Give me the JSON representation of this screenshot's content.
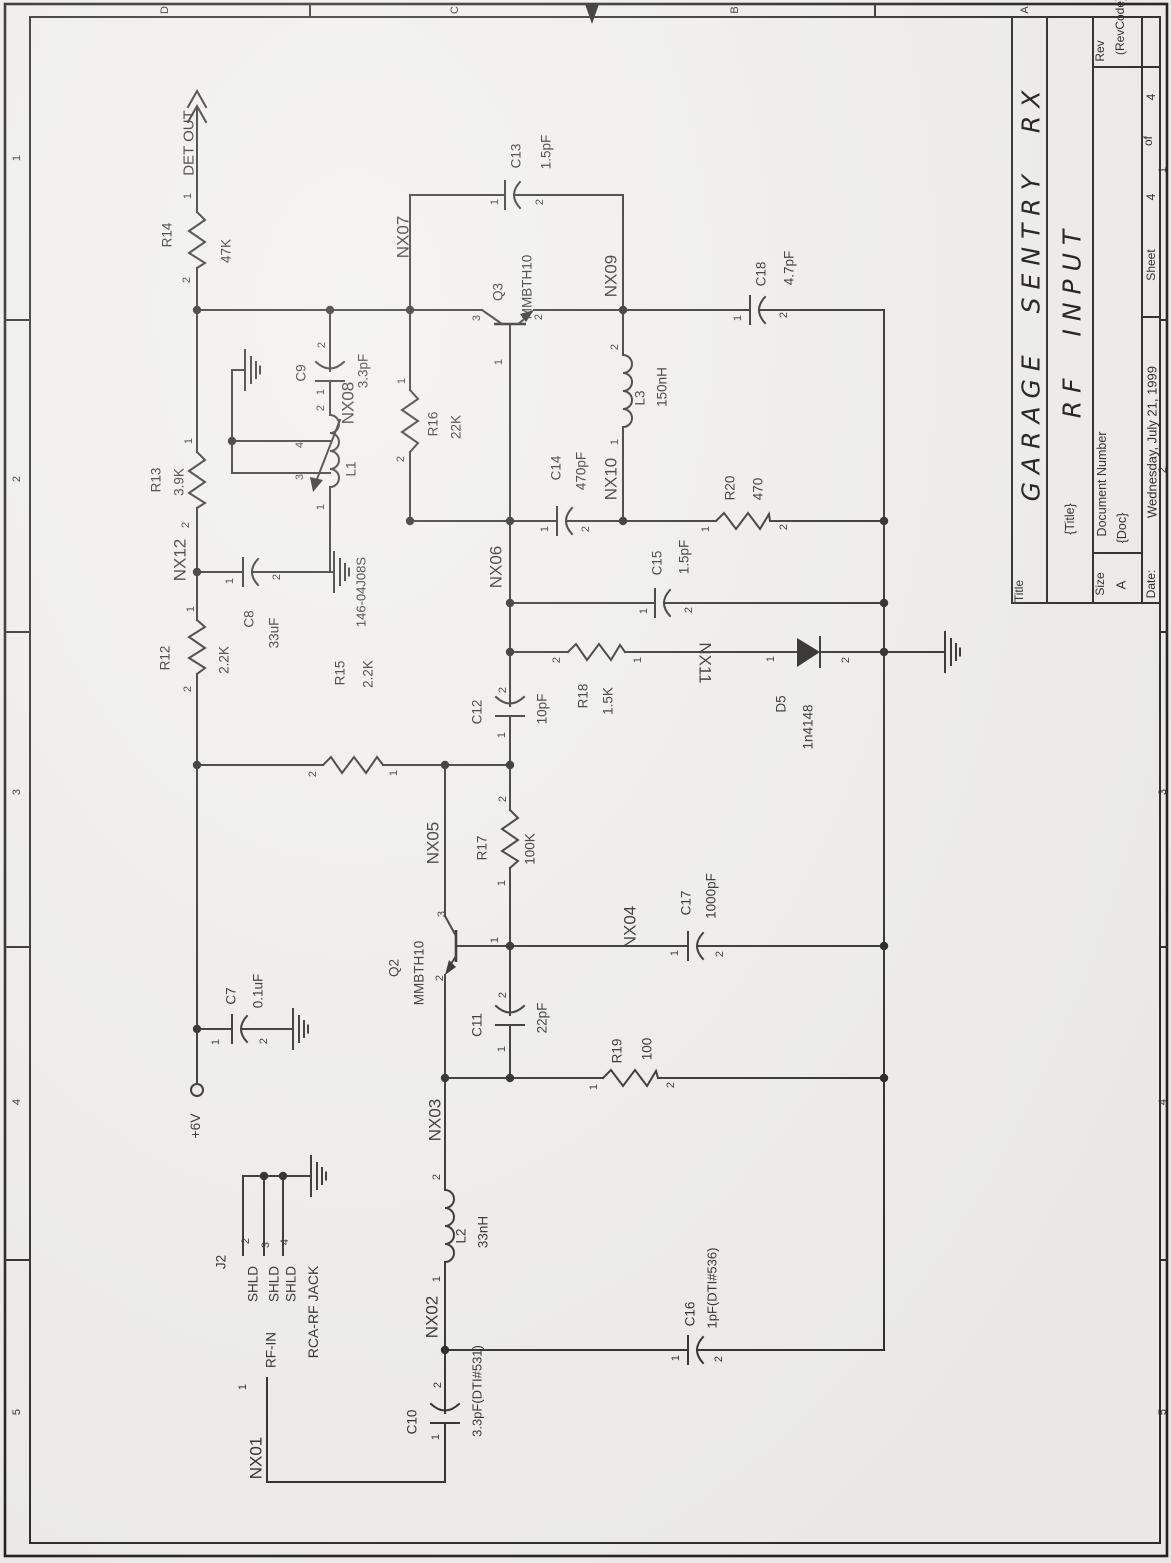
{
  "colors": {
    "paper": "#f1f0ed",
    "ink": "#2b2a28"
  },
  "document_type": "scanned schematic sheet",
  "title_block": {
    "title": "GARAGE SENTRY RX",
    "subtitle": "RF INPUT",
    "size": "A",
    "doc": "{Doc}",
    "rev": "(RevCode)",
    "date": "Wednesday, July 21, 1999",
    "sheet": "4",
    "sheet_of": "4"
  },
  "labels": [
    {
      "n": "zone-letter-d",
      "t": "D",
      "x": 165,
      "y": 10,
      "s": 11
    },
    {
      "n": "zone-letter-c",
      "t": "C",
      "x": 455,
      "y": 10,
      "s": 11
    },
    {
      "n": "zone-letter-b",
      "t": "B",
      "x": 735,
      "y": 10,
      "s": 11
    },
    {
      "n": "zone-letter-a",
      "t": "A",
      "x": 1025,
      "y": 10,
      "s": 11
    },
    {
      "n": "zone-num-left-1",
      "t": "1",
      "x": 17,
      "y": 158,
      "s": 11
    },
    {
      "n": "zone-num-left-2",
      "t": "2",
      "x": 17,
      "y": 479,
      "s": 11
    },
    {
      "n": "zone-num-left-3",
      "t": "3",
      "x": 17,
      "y": 792,
      "s": 11
    },
    {
      "n": "zone-num-left-4",
      "t": "4",
      "x": 17,
      "y": 1102,
      "s": 11
    },
    {
      "n": "zone-num-left-5",
      "t": "5",
      "x": 17,
      "y": 1412,
      "s": 11
    },
    {
      "n": "zone-num-right-1",
      "t": "1",
      "x": 1163,
      "y": 170,
      "s": 11
    },
    {
      "n": "zone-num-right-2",
      "t": "2",
      "x": 1163,
      "y": 470,
      "s": 11
    },
    {
      "n": "zone-num-right-3",
      "t": "3",
      "x": 1163,
      "y": 792,
      "s": 11
    },
    {
      "n": "zone-num-right-4",
      "t": "4",
      "x": 1163,
      "y": 1102,
      "s": 11
    },
    {
      "n": "zone-num-right-5",
      "t": "5",
      "x": 1163,
      "y": 1412,
      "s": 11
    },
    {
      "n": "tb-title-label",
      "t": "Title",
      "x": 1019,
      "y": 591,
      "s": 12
    },
    {
      "n": "tb-title-value",
      "t": "GARAGE SENTRY RX",
      "x": 1031,
      "y": 292,
      "s": 25,
      "c": "hand"
    },
    {
      "n": "tb-subtitle-label",
      "t": "{Title}",
      "x": 1070,
      "y": 519,
      "s": 12.5
    },
    {
      "n": "tb-subtitle-value",
      "t": "RF INPUT",
      "x": 1072,
      "y": 320,
      "s": 25,
      "c": "hand"
    },
    {
      "n": "tb-rev-label",
      "t": "Rev",
      "x": 1100,
      "y": 51,
      "s": 12
    },
    {
      "n": "tb-rev-value",
      "t": "(RevCode)",
      "x": 1120,
      "y": 26,
      "s": 12
    },
    {
      "n": "tb-doc-label",
      "t": "Document Number",
      "x": 1102,
      "y": 484,
      "s": 12.5
    },
    {
      "n": "tb-doc-value",
      "t": "{Doc}",
      "x": 1122,
      "y": 528,
      "s": 12.5
    },
    {
      "n": "tb-size-label",
      "t": "Size",
      "x": 1100,
      "y": 584,
      "s": 12
    },
    {
      "n": "tb-size-value",
      "t": "A",
      "x": 1121,
      "y": 585,
      "s": 13
    },
    {
      "n": "tb-date-label",
      "t": "Date:",
      "x": 1151,
      "y": 584,
      "s": 12
    },
    {
      "n": "tb-date-value",
      "t": "Wednesday, July 21, 1999",
      "x": 1152,
      "y": 442,
      "s": 13
    },
    {
      "n": "tb-sheet-label",
      "t": "Sheet",
      "x": 1151,
      "y": 265,
      "s": 12
    },
    {
      "n": "tb-sheet-num",
      "t": "4",
      "x": 1151,
      "y": 197,
      "s": 12
    },
    {
      "n": "tb-of-label",
      "t": "of",
      "x": 1148,
      "y": 141,
      "s": 12
    },
    {
      "n": "tb-sheet-total",
      "t": "4",
      "x": 1151,
      "y": 97,
      "s": 12
    },
    {
      "n": "net-det-out",
      "t": "DET OUT",
      "x": 189,
      "y": 143,
      "s": 15
    },
    {
      "n": "r14-pin1",
      "t": "1",
      "x": 188,
      "y": 196,
      "s": 11
    },
    {
      "n": "r14-ref",
      "t": "R14",
      "x": 167,
      "y": 235
    },
    {
      "n": "r14-val",
      "t": "47K",
      "x": 226,
      "y": 251
    },
    {
      "n": "r14-pin2",
      "t": "2",
      "x": 187,
      "y": 280,
      "s": 11
    },
    {
      "n": "r13-pin1",
      "t": "1",
      "x": 189,
      "y": 441,
      "s": 11
    },
    {
      "n": "r13-ref",
      "t": "R13",
      "x": 156,
      "y": 480
    },
    {
      "n": "r13-val",
      "t": "3.9K",
      "x": 179,
      "y": 482
    },
    {
      "n": "r13-pin2",
      "t": "2",
      "x": 186,
      "y": 525,
      "s": 11
    },
    {
      "n": "net-nx12",
      "t": "NX12",
      "x": 180,
      "y": 560,
      "s": 17
    },
    {
      "n": "r12-pin1",
      "t": "1",
      "x": 191,
      "y": 609,
      "s": 11
    },
    {
      "n": "r12-ref",
      "t": "R12",
      "x": 165,
      "y": 658
    },
    {
      "n": "r12-val",
      "t": "2.2K",
      "x": 224,
      "y": 660
    },
    {
      "n": "r12-pin2",
      "t": "2",
      "x": 188,
      "y": 689,
      "s": 11
    },
    {
      "n": "c8-pin1",
      "t": "1",
      "x": 230,
      "y": 581,
      "s": 11
    },
    {
      "n": "c8-ref",
      "t": "C8",
      "x": 249,
      "y": 619
    },
    {
      "n": "c8-val",
      "t": "33uF",
      "x": 274,
      "y": 633
    },
    {
      "n": "c8-pin2",
      "t": "2",
      "x": 277,
      "y": 577,
      "s": 11
    },
    {
      "n": "l1-part",
      "t": "146-04J08S",
      "x": 361,
      "y": 592,
      "s": 13
    },
    {
      "n": "c9-pin2",
      "t": "2",
      "x": 322,
      "y": 345,
      "s": 11
    },
    {
      "n": "c9-ref",
      "t": "C9",
      "x": 301,
      "y": 373
    },
    {
      "n": "c9-val",
      "t": "3.3pF",
      "x": 363,
      "y": 371
    },
    {
      "n": "c9-pin1",
      "t": "1",
      "x": 321,
      "y": 392,
      "s": 11
    },
    {
      "n": "net-nx08",
      "t": "NX08",
      "x": 348,
      "y": 403,
      "s": 17
    },
    {
      "n": "l1-pin2",
      "t": "2",
      "x": 321,
      "y": 408,
      "s": 11
    },
    {
      "n": "l1-ref",
      "t": "L1",
      "x": 351,
      "y": 469
    },
    {
      "n": "l1-pin4",
      "t": "4",
      "x": 300,
      "y": 445,
      "s": 11
    },
    {
      "n": "l1-pin3",
      "t": "3",
      "x": 300,
      "y": 477,
      "s": 11
    },
    {
      "n": "l1-pin1",
      "t": "1",
      "x": 321,
      "y": 507,
      "s": 11
    },
    {
      "n": "net-nx07",
      "t": "NX07",
      "x": 403,
      "y": 237,
      "s": 17
    },
    {
      "n": "c13-pin1",
      "t": "1",
      "x": 495,
      "y": 202,
      "s": 11
    },
    {
      "n": "c13-ref",
      "t": "C13",
      "x": 516,
      "y": 156
    },
    {
      "n": "c13-val",
      "t": "1.5pF",
      "x": 546,
      "y": 152
    },
    {
      "n": "c13-pin2",
      "t": "2",
      "x": 540,
      "y": 202,
      "s": 11
    },
    {
      "n": "r16-pin1",
      "t": "1",
      "x": 402,
      "y": 381,
      "s": 11
    },
    {
      "n": "r16-ref",
      "t": "R16",
      "x": 433,
      "y": 424
    },
    {
      "n": "r16-val",
      "t": "22K",
      "x": 456,
      "y": 427
    },
    {
      "n": "r16-pin2",
      "t": "2",
      "x": 401,
      "y": 459,
      "s": 11
    },
    {
      "n": "q3-ref",
      "t": "Q3",
      "x": 498,
      "y": 292
    },
    {
      "n": "q3-val",
      "t": "MMBTH10",
      "x": 527,
      "y": 287
    },
    {
      "n": "q3-pin3",
      "t": "3",
      "x": 477,
      "y": 318,
      "s": 11
    },
    {
      "n": "q3-pin2",
      "t": "2",
      "x": 539,
      "y": 317,
      "s": 11
    },
    {
      "n": "q3-pin1",
      "t": "1",
      "x": 499,
      "y": 362,
      "s": 11
    },
    {
      "n": "net-nx09",
      "t": "NX09",
      "x": 611,
      "y": 276,
      "s": 17
    },
    {
      "n": "c18-pin1",
      "t": "1",
      "x": 738,
      "y": 318,
      "s": 11
    },
    {
      "n": "c18-ref",
      "t": "C18",
      "x": 761,
      "y": 274
    },
    {
      "n": "c18-val",
      "t": "4.7pF",
      "x": 789,
      "y": 268
    },
    {
      "n": "c18-pin2",
      "t": "2",
      "x": 784,
      "y": 315,
      "s": 11
    },
    {
      "n": "l3-pin2",
      "t": "2",
      "x": 615,
      "y": 347,
      "s": 11
    },
    {
      "n": "l3-ref",
      "t": "L3",
      "x": 640,
      "y": 398
    },
    {
      "n": "l3-val",
      "t": "150nH",
      "x": 662,
      "y": 387
    },
    {
      "n": "l3-pin1",
      "t": "1",
      "x": 615,
      "y": 442,
      "s": 11
    },
    {
      "n": "net-nx10",
      "t": "NX10",
      "x": 611,
      "y": 479,
      "s": 17
    },
    {
      "n": "c14-pin1",
      "t": "1",
      "x": 545,
      "y": 529,
      "s": 11
    },
    {
      "n": "c14-ref",
      "t": "C14",
      "x": 556,
      "y": 468
    },
    {
      "n": "c14-val",
      "t": "470pF",
      "x": 581,
      "y": 471
    },
    {
      "n": "c14-pin2",
      "t": "2",
      "x": 586,
      "y": 529,
      "s": 11
    },
    {
      "n": "r20-pin1",
      "t": "1",
      "x": 706,
      "y": 529,
      "s": 11
    },
    {
      "n": "r20-ref",
      "t": "R20",
      "x": 730,
      "y": 488
    },
    {
      "n": "r20-val",
      "t": "470",
      "x": 758,
      "y": 489
    },
    {
      "n": "r20-pin2",
      "t": "2",
      "x": 784,
      "y": 527,
      "s": 11
    },
    {
      "n": "net-nx06",
      "t": "NX06",
      "x": 496,
      "y": 567,
      "s": 17
    },
    {
      "n": "c15-pin1",
      "t": "1",
      "x": 644,
      "y": 611,
      "s": 11
    },
    {
      "n": "c15-ref",
      "t": "C15",
      "x": 657,
      "y": 563
    },
    {
      "n": "c15-val",
      "t": "1.5pF",
      "x": 684,
      "y": 557
    },
    {
      "n": "c15-pin2",
      "t": "2",
      "x": 689,
      "y": 610,
      "s": 11
    },
    {
      "n": "r18-pin2",
      "t": "2",
      "x": 557,
      "y": 660,
      "s": 11
    },
    {
      "n": "r18-ref",
      "t": "R18",
      "x": 583,
      "y": 696
    },
    {
      "n": "r18-val",
      "t": "1.5K",
      "x": 608,
      "y": 701
    },
    {
      "n": "r18-pin1",
      "t": "1",
      "x": 638,
      "y": 660,
      "s": 11
    },
    {
      "n": "net-nx11",
      "t": "NX11",
      "x": 705,
      "y": 663,
      "s": 17,
      "r": 90
    },
    {
      "n": "d5-pin1",
      "t": "1",
      "x": 771,
      "y": 659,
      "s": 11
    },
    {
      "n": "d5-ref",
      "t": "D5",
      "x": 781,
      "y": 704
    },
    {
      "n": "d5-val",
      "t": "1n4148",
      "x": 808,
      "y": 727
    },
    {
      "n": "d5-pin2",
      "t": "2",
      "x": 846,
      "y": 660,
      "s": 11
    },
    {
      "n": "r15-pin2",
      "t": "2",
      "x": 313,
      "y": 774,
      "s": 11
    },
    {
      "n": "r15-ref",
      "t": "R15",
      "x": 340,
      "y": 673
    },
    {
      "n": "r15-val",
      "t": "2.2K",
      "x": 368,
      "y": 674
    },
    {
      "n": "r15-pin1",
      "t": "1",
      "x": 394,
      "y": 773,
      "s": 11
    },
    {
      "n": "c12-pin2",
      "t": "2",
      "x": 503,
      "y": 690,
      "s": 11
    },
    {
      "n": "c12-ref",
      "t": "C12",
      "x": 477,
      "y": 712
    },
    {
      "n": "c12-val",
      "t": "10pF",
      "x": 542,
      "y": 709
    },
    {
      "n": "c12-pin1",
      "t": "1",
      "x": 502,
      "y": 735,
      "s": 11
    },
    {
      "n": "net-nx05",
      "t": "NX05",
      "x": 433,
      "y": 843,
      "s": 17
    },
    {
      "n": "r17-pin2",
      "t": "2",
      "x": 503,
      "y": 799,
      "s": 11
    },
    {
      "n": "r17-ref",
      "t": "R17",
      "x": 482,
      "y": 848
    },
    {
      "n": "r17-val",
      "t": "100K",
      "x": 530,
      "y": 849
    },
    {
      "n": "r17-pin1",
      "t": "1",
      "x": 502,
      "y": 883,
      "s": 11
    },
    {
      "n": "q2-ref",
      "t": "Q2",
      "x": 394,
      "y": 968
    },
    {
      "n": "q2-val",
      "t": "MMBTH10",
      "x": 419,
      "y": 973
    },
    {
      "n": "q2-pin3",
      "t": "3",
      "x": 442,
      "y": 914,
      "s": 11
    },
    {
      "n": "q2-pin1",
      "t": "1",
      "x": 495,
      "y": 940,
      "s": 11
    },
    {
      "n": "q2-pin2",
      "t": "2",
      "x": 440,
      "y": 978,
      "s": 11
    },
    {
      "n": "net-nx04",
      "t": "NX04",
      "x": 630,
      "y": 927,
      "s": 17
    },
    {
      "n": "c17-pin1",
      "t": "1",
      "x": 675,
      "y": 953,
      "s": 11
    },
    {
      "n": "c17-ref",
      "t": "C17",
      "x": 686,
      "y": 903
    },
    {
      "n": "c17-val",
      "t": "1000pF",
      "x": 711,
      "y": 896
    },
    {
      "n": "c17-pin2",
      "t": "2",
      "x": 720,
      "y": 954,
      "s": 11
    },
    {
      "n": "c11-pin2",
      "t": "2",
      "x": 503,
      "y": 995,
      "s": 11
    },
    {
      "n": "c11-ref",
      "t": "C11",
      "x": 477,
      "y": 1025
    },
    {
      "n": "c11-val",
      "t": "22pF",
      "x": 542,
      "y": 1018
    },
    {
      "n": "c11-pin1",
      "t": "1",
      "x": 502,
      "y": 1049,
      "s": 11
    },
    {
      "n": "r19-pin1",
      "t": "1",
      "x": 594,
      "y": 1087,
      "s": 11
    },
    {
      "n": "r19-ref",
      "t": "R19",
      "x": 617,
      "y": 1051
    },
    {
      "n": "r19-val",
      "t": "100",
      "x": 647,
      "y": 1049
    },
    {
      "n": "r19-pin2",
      "t": "2",
      "x": 671,
      "y": 1085,
      "s": 11
    },
    {
      "n": "net-nx03",
      "t": "NX03",
      "x": 435,
      "y": 1120,
      "s": 17
    },
    {
      "n": "c7-pin1",
      "t": "1",
      "x": 216,
      "y": 1042,
      "s": 11
    },
    {
      "n": "c7-ref",
      "t": "C7",
      "x": 231,
      "y": 996
    },
    {
      "n": "c7-val",
      "t": "0.1uF",
      "x": 258,
      "y": 991
    },
    {
      "n": "c7-pin2",
      "t": "2",
      "x": 264,
      "y": 1041,
      "s": 11
    },
    {
      "n": "net-plus6v",
      "t": "+6V",
      "x": 195,
      "y": 1126,
      "s": 14
    },
    {
      "n": "j2-ref",
      "t": "J2",
      "x": 221,
      "y": 1262
    },
    {
      "n": "j2-pin2-num",
      "t": "2",
      "x": 246,
      "y": 1241,
      "s": 11
    },
    {
      "n": "j2-pin3-num",
      "t": "3",
      "x": 266,
      "y": 1245,
      "s": 11
    },
    {
      "n": "j2-pin4-num",
      "t": "4",
      "x": 285,
      "y": 1242,
      "s": 11
    },
    {
      "n": "j2-shld-a",
      "t": "SHLD",
      "x": 253,
      "y": 1284
    },
    {
      "n": "j2-shld-b",
      "t": "SHLD",
      "x": 274,
      "y": 1284
    },
    {
      "n": "j2-shld-c",
      "t": "SHLD",
      "x": 291,
      "y": 1284
    },
    {
      "n": "j2-jack-name",
      "t": "RCA-RF JACK",
      "x": 313,
      "y": 1312,
      "s": 14
    },
    {
      "n": "j2-rf-in",
      "t": "RF-IN",
      "x": 271,
      "y": 1350
    },
    {
      "n": "j2-pin1-num",
      "t": "1",
      "x": 243,
      "y": 1387,
      "s": 11
    },
    {
      "n": "l2-pin2",
      "t": "2",
      "x": 437,
      "y": 1177,
      "s": 11
    },
    {
      "n": "l2-ref",
      "t": "L2",
      "x": 461,
      "y": 1236
    },
    {
      "n": "l2-val",
      "t": "33nH",
      "x": 483,
      "y": 1232
    },
    {
      "n": "l2-pin1",
      "t": "1",
      "x": 437,
      "y": 1279,
      "s": 11
    },
    {
      "n": "net-nx02",
      "t": "NX02",
      "x": 432,
      "y": 1317,
      "s": 17
    },
    {
      "n": "c10-pin2",
      "t": "2",
      "x": 438,
      "y": 1385,
      "s": 11
    },
    {
      "n": "c10-ref",
      "t": "C10",
      "x": 412,
      "y": 1422
    },
    {
      "n": "c10-val",
      "t": "3.3pF(DTI#531)",
      "x": 477,
      "y": 1391,
      "s": 13
    },
    {
      "n": "c10-pin1",
      "t": "1",
      "x": 436,
      "y": 1437,
      "s": 11
    },
    {
      "n": "net-nx01",
      "t": "NX01",
      "x": 256,
      "y": 1458,
      "s": 17
    },
    {
      "n": "c16-pin1",
      "t": "1",
      "x": 676,
      "y": 1358,
      "s": 11
    },
    {
      "n": "c16-ref",
      "t": "C16",
      "x": 690,
      "y": 1314
    },
    {
      "n": "c16-val",
      "t": "1pF(DTI#536)",
      "x": 712,
      "y": 1288,
      "s": 13
    },
    {
      "n": "c16-pin2",
      "t": "2",
      "x": 719,
      "y": 1359,
      "s": 11
    }
  ]
}
